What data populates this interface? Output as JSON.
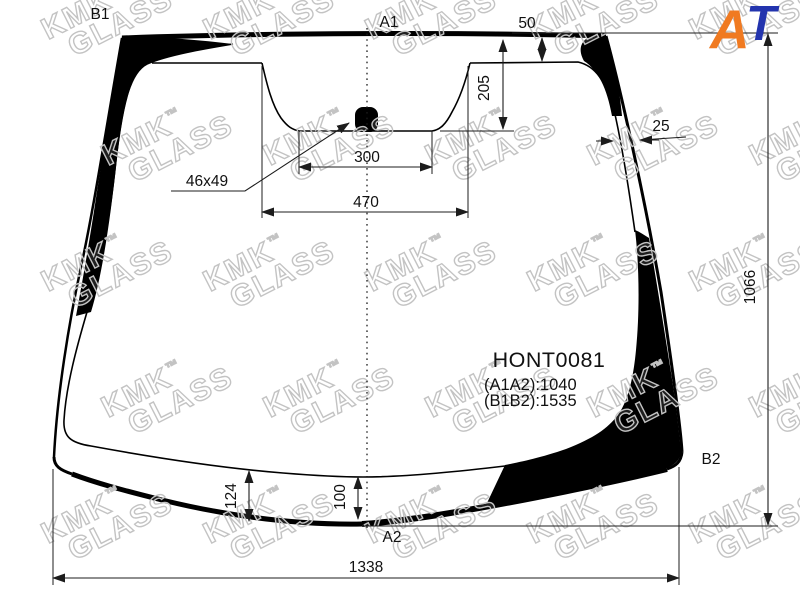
{
  "watermark": {
    "kmk": "KMK",
    "tm": "™",
    "glass": "GLASS"
  },
  "logo": {
    "a": "A",
    "t": "T"
  },
  "colors": {
    "logo_a": "#f07a21",
    "logo_t": "#2334ae"
  },
  "part": {
    "code": "HONT0081",
    "spec_a": "(A1A2):1040",
    "spec_b": "(B1B2):1535"
  },
  "corner_labels": {
    "top_left": "B1",
    "top_center": "A1",
    "bottom_center": "A2",
    "bottom_right": "B2"
  },
  "dims": {
    "top_band": "50",
    "sensor_depth": "205",
    "side_band": "25",
    "sensor_inner_width": "300",
    "sensor_outer_width": "470",
    "sensor_size": "46x49",
    "height_right": "1066",
    "bottom_band_left": "124",
    "bottom_band_center": "100",
    "bottom_width": "1338"
  }
}
